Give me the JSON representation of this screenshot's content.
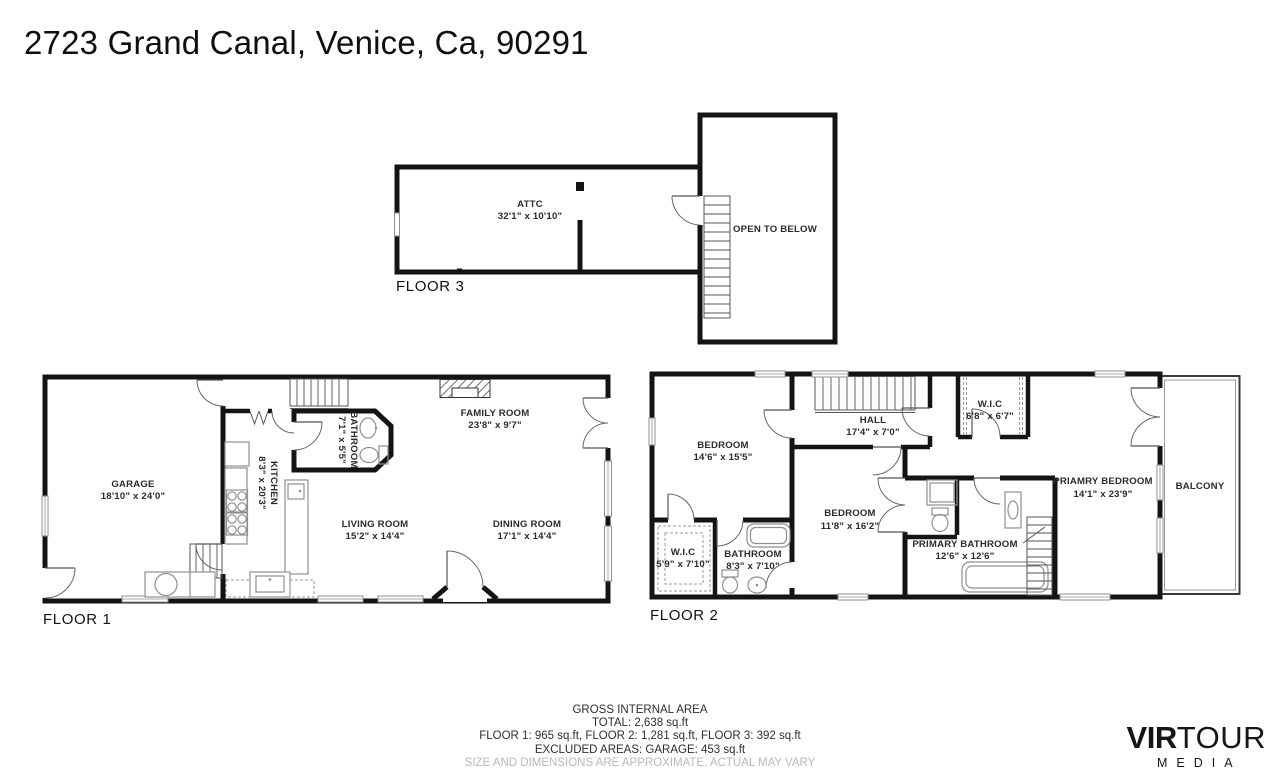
{
  "title": "2723 Grand Canal, Venice, Ca, 90291",
  "floors": {
    "floor3": {
      "label": "FLOOR 3",
      "rooms": {
        "attic": {
          "name": "ATTC",
          "dims": "32'1\" x 10'10\""
        },
        "open_below": {
          "name": "OPEN TO BELOW"
        }
      }
    },
    "floor1": {
      "label": "FLOOR 1",
      "rooms": {
        "garage": {
          "name": "GARAGE",
          "dims": "18'10\" x 24'0\""
        },
        "kitchen": {
          "name": "KITCHEN",
          "dims": "8'3\" x 20'3\""
        },
        "bathroom": {
          "name": "BATHROOM",
          "dims": "7'1\" x 5'5\""
        },
        "family": {
          "name": "FAMILY ROOM",
          "dims": "23'8\" x 9'7\""
        },
        "living": {
          "name": "LIVING ROOM",
          "dims": "15'2\" x 14'4\""
        },
        "dining": {
          "name": "DINING ROOM",
          "dims": "17'1\" x 14'4\""
        }
      }
    },
    "floor2": {
      "label": "FLOOR 2",
      "rooms": {
        "bedroom1": {
          "name": "BEDROOM",
          "dims": "14'6\" x 15'5\""
        },
        "hall": {
          "name": "HALL",
          "dims": "17'4\" x 7'0\""
        },
        "wic_top": {
          "name": "W.I.C",
          "dims": "6'8\" x 6'7\""
        },
        "primary_bedroom": {
          "name": "PRIAMRY BEDROOM",
          "dims": "14'1\" x 23'9\""
        },
        "balcony": {
          "name": "BALCONY"
        },
        "bedroom2": {
          "name": "BEDROOM",
          "dims": "11'8\" x 16'2\""
        },
        "wic_bottom": {
          "name": "W.I.C",
          "dims": "5'9\" x 7'10\""
        },
        "bathroom": {
          "name": "BATHROOM",
          "dims": "8'3\" x 7'10\""
        },
        "primary_bathroom": {
          "name": "PRIMARY BATHROOM",
          "dims": "12'6\" x 12'6\""
        }
      }
    }
  },
  "footer": {
    "line1": "GROSS INTERNAL AREA",
    "line2": "TOTAL: 2,638 sq.ft",
    "line3": "FLOOR 1: 965 sq.ft, FLOOR 2: 1,281 sq.ft, FLOOR 3: 392 sq.ft",
    "line4": "EXCLUDED AREAS: GARAGE: 453 sq.ft",
    "line5": "SIZE AND DIMENSIONS ARE APPROXIMATE, ACTUAL MAY VARY"
  },
  "logo": {
    "brand_bold": "VIR",
    "brand_light": "TOUR",
    "brand_sub": "MEDIA"
  },
  "colors": {
    "wall": "#141414",
    "fixture": "#8f8f8f",
    "label_text": "#2b2b2b",
    "disclaimer": "#b9b9b9"
  }
}
